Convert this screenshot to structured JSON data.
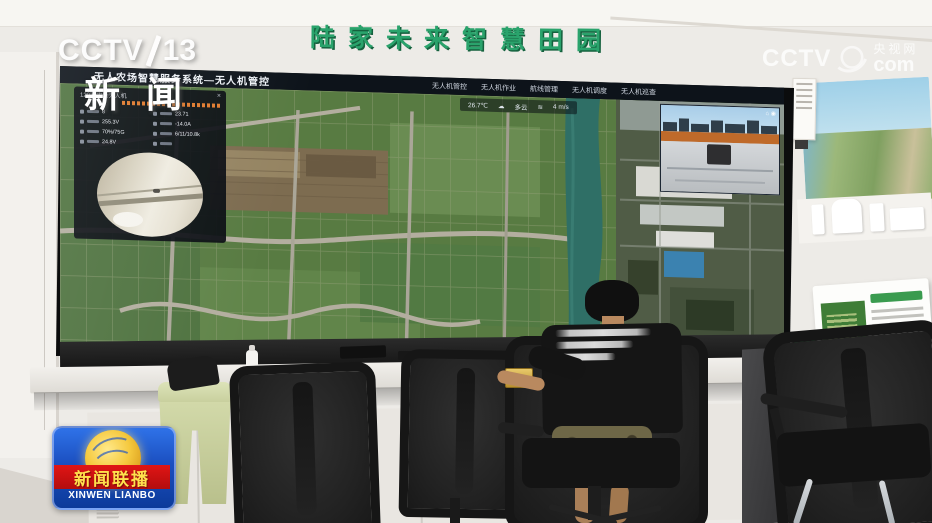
{
  "broadcast": {
    "channel_logo": {
      "network": "CCTV",
      "channel": "13"
    },
    "news_banner": "新闻",
    "watermark": {
      "network": "CCTV",
      "site": "央视网",
      "domain": "com"
    },
    "program_badge": {
      "title": "新闻联播",
      "romanized": "XINWEN LIANBO"
    }
  },
  "scene": {
    "wall_sign": "陆家未来智慧田园"
  },
  "control_screen": {
    "header_title": "无人农场智慧服务系统—无人机管控",
    "menu_items": [
      "无人机管控",
      "无人机作业",
      "航线管理",
      "无人机调度",
      "无人机巡查"
    ],
    "status_bar": {
      "temperature": "26.7℃",
      "weather_icon": "☁",
      "weather": "多云",
      "wind_icon": "≋",
      "wind_speed": "4 m/s"
    },
    "mode_chip": "无人机管控",
    "telemetry_panel": {
      "title": "12074农场无人机",
      "close_icon": "×",
      "readings": [
        "8",
        "23.71",
        "255.3V",
        "-14.0A",
        "70%/75G",
        "6/11/10.8k",
        "24.8V"
      ]
    },
    "feed_icons": "⌂ ◉"
  },
  "colors": {
    "sign_green": "#2aa36c",
    "wainscot_green": "#2f8f4e",
    "badge_blue": "#1b4fc0",
    "badge_red": "#d01111",
    "badge_yellow": "#ffe14d",
    "map_green": "#587b42",
    "river_teal": "#2f6f66"
  }
}
